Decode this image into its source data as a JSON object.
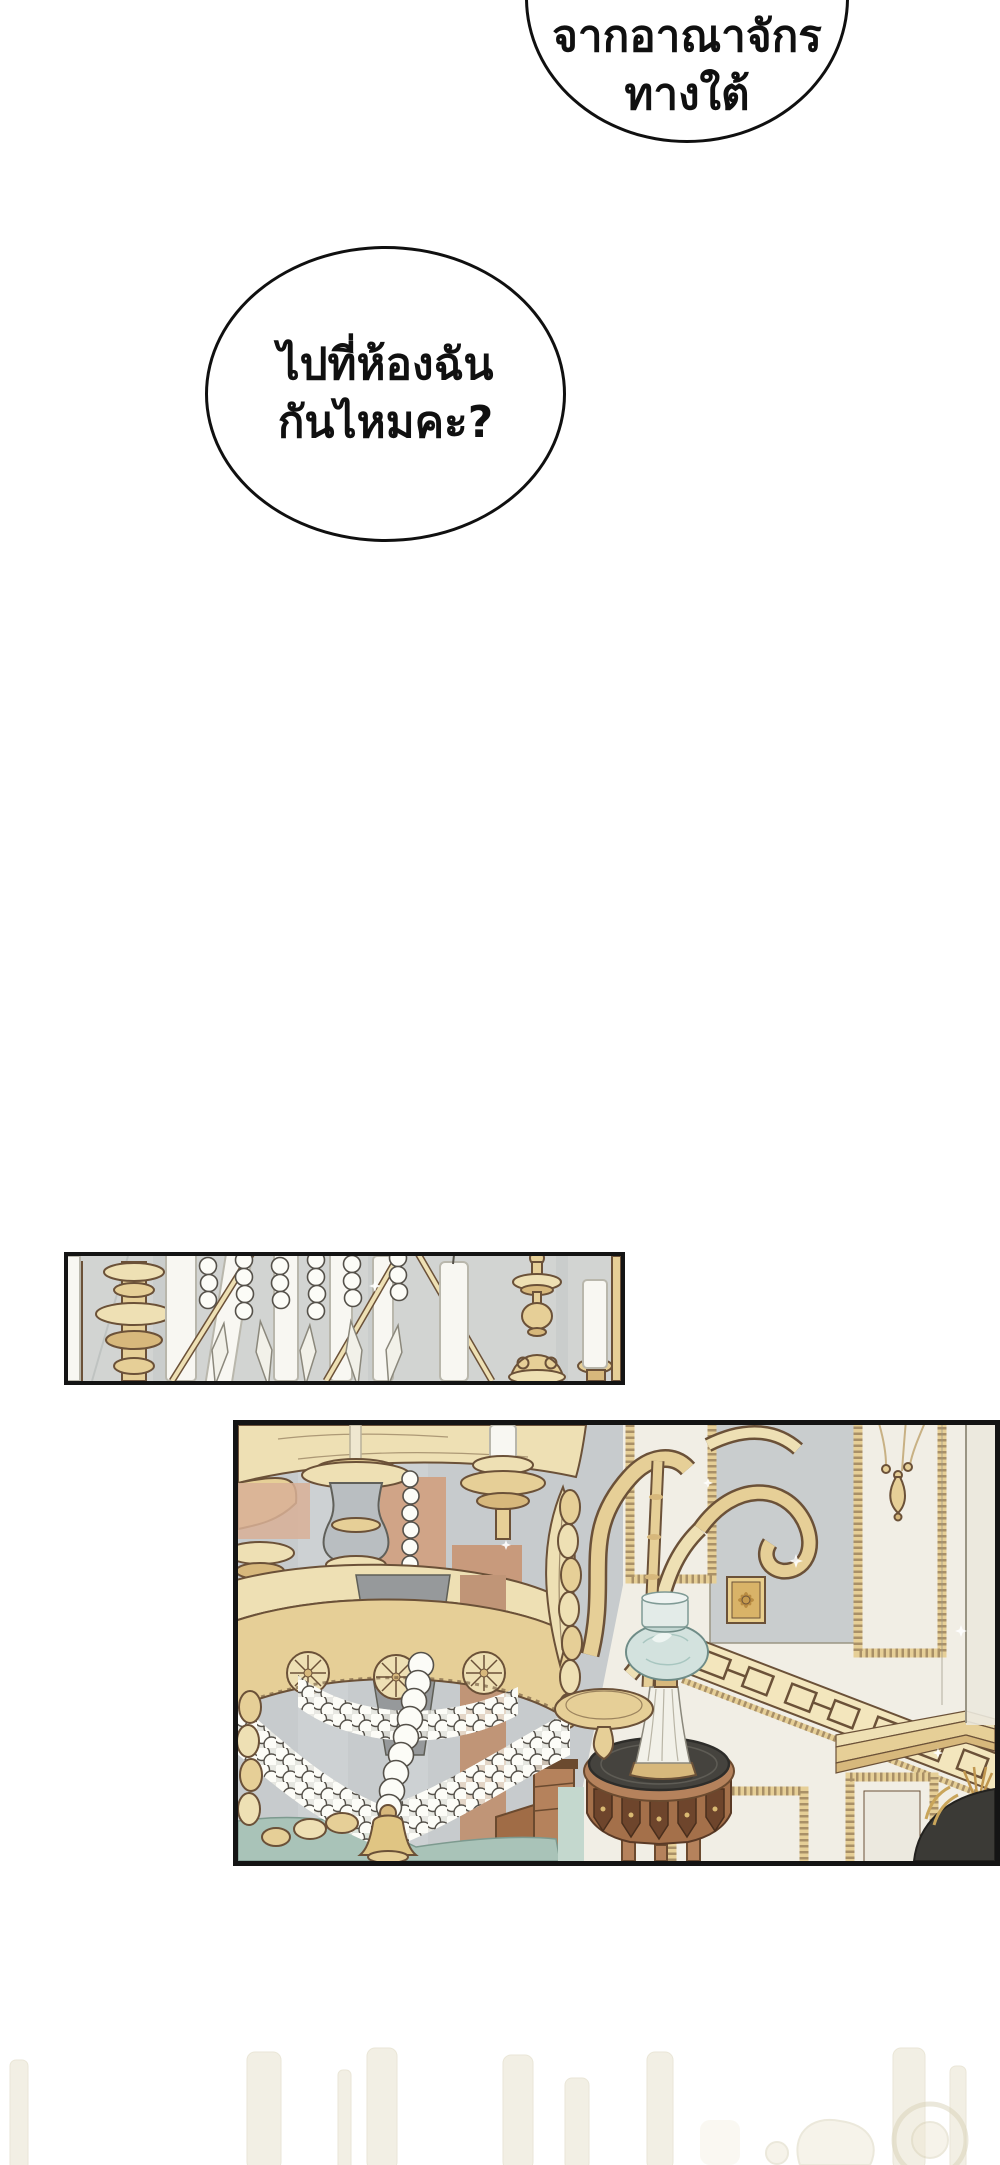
{
  "page": {
    "width": 1000,
    "height": 2165,
    "background": "#ffffff",
    "kind": "webtoon-comic-page"
  },
  "speech_bubbles": [
    {
      "name": "bubble-top",
      "lines": [
        "จากอาณาจักร",
        "ทางใต้"
      ]
    },
    {
      "name": "bubble-main",
      "lines": [
        "ไปที่ห้องฉัน",
        "กันไหมคะ?"
      ]
    }
  ],
  "panels": [
    {
      "name": "panel-candles-strip",
      "alt": "close-up-of-candles-and-crystal-bead-strings-on-gold-chandelier"
    },
    {
      "name": "panel-room",
      "alt": "gold-chandelier-with-pearl-garlands-paneled-wall-oil-lamp-on-round-side-table"
    }
  ],
  "palette": {
    "ink": "#141414",
    "paper": "#ffffff",
    "panelGray": "#c7cbcd",
    "stripGray": "#d2d4d2",
    "goldL": "#eee0b4",
    "gold": "#e6cf97",
    "goldD": "#d7b87c",
    "goldEdge": "#6b5138",
    "candle": "#f8f7f2",
    "candleEdge": "#b9b7ac",
    "bead": "#fcfcf7",
    "beadEdge": "#55514a",
    "wallCream": "#f1eee5",
    "wallShade": "#c9cdce",
    "wallEdge": "#9a9584",
    "wood": "#b5825c",
    "woodD": "#6b4a2f",
    "tableTop": "#45433e",
    "glass": "#d3e2de",
    "glassEdge": "#6f8c87",
    "crystal": "#f2f1e9",
    "teal": "#a9c3b8",
    "salmon": "#d8b096",
    "shade": "#96999b",
    "ghost": "#e9e3cf",
    "ghostEdge": "#d9d2b8"
  }
}
